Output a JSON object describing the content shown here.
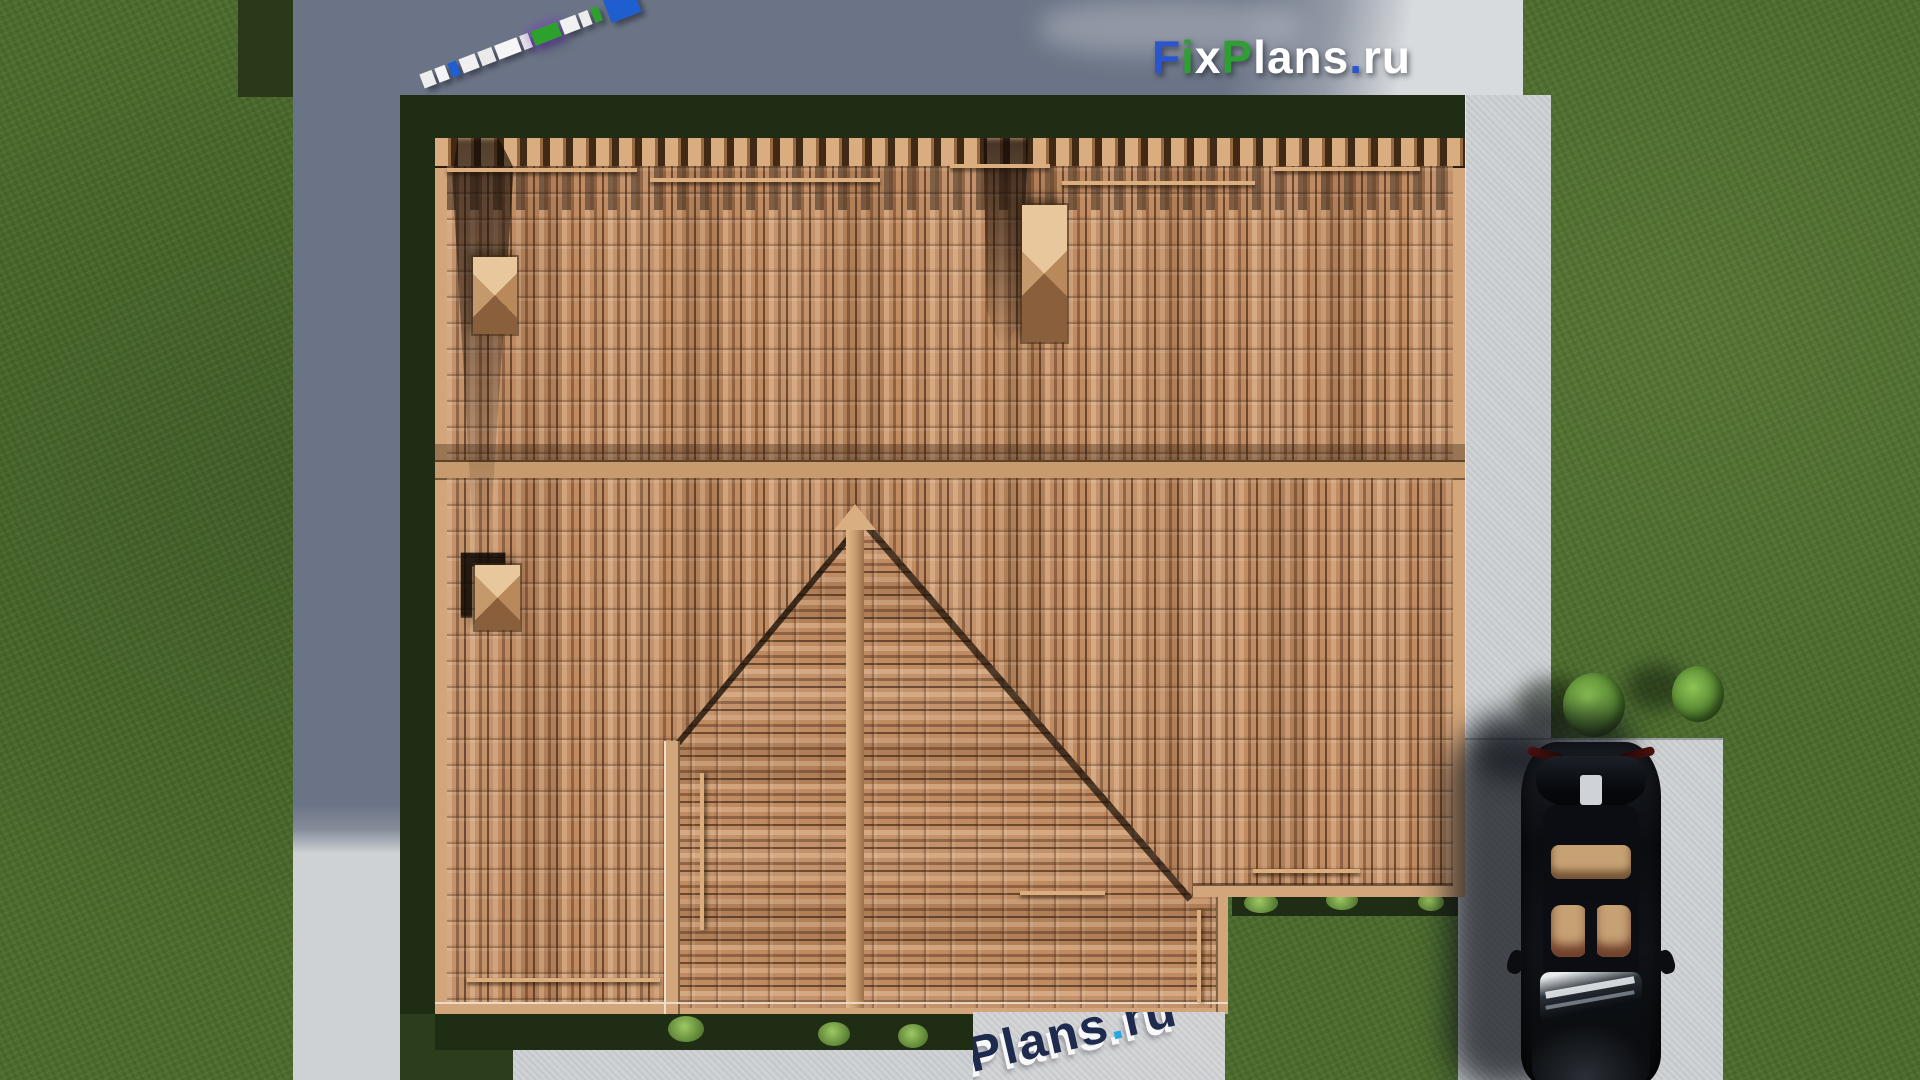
{
  "page": {
    "title": "FixPlans.ru — aerial top view render of tiled hip roof house"
  },
  "logo": {
    "parts": [
      {
        "text": "F",
        "style": "color:#2a55cd"
      },
      {
        "text": "i",
        "style": "color:#2f9e33"
      },
      {
        "text": "x",
        "style": "color:#ffffff"
      },
      {
        "text": "P",
        "style": "color:#2f9e33"
      },
      {
        "text": "lans",
        "style": "color:#ffffff"
      },
      {
        "text": ".",
        "style": "color:#2a55cd"
      },
      {
        "text": "ru",
        "style": "color:#ffffff"
      }
    ]
  },
  "watermark": {
    "parts": [
      {
        "text": "Plans",
        "style": "color:#1e2b4e"
      },
      {
        "text": ".",
        "style": "color:#27a8e0"
      },
      {
        "text": "ru",
        "style": "color:#1e2b4e"
      }
    ]
  },
  "ruler": {
    "segments": [
      {
        "color": "#ededed",
        "w": 13
      },
      {
        "color": "#f4f4f4",
        "w": 11
      },
      {
        "color": "#1f5ecf",
        "w": 9
      },
      {
        "color": "#f0f0f0",
        "w": 17
      },
      {
        "color": "#eaeaea",
        "w": 15
      },
      {
        "color": "#f6f6f6",
        "w": 24
      },
      {
        "color": "#e8e8e8",
        "w": 9
      },
      {
        "color": "#2ea02e",
        "w": 28,
        "glow": true
      },
      {
        "color": "#f1f1f1",
        "w": 17
      },
      {
        "color": "#ececec",
        "w": 10
      },
      {
        "color": "#2ea02e",
        "w": 8
      }
    ],
    "end_block": {
      "color": "#1f5ecf",
      "w": 32,
      "h": 27
    }
  },
  "palette": {
    "grass": "#4c6b2e",
    "grass-dark": "#1f2d14",
    "concrete-light": "#ced2d5",
    "concrete-shadow": "#6b7486",
    "roof-tile": "#c08b61",
    "roof-trim": "#d2a57a",
    "car-body": "#0b0d11",
    "car-seat": "#c6a174",
    "logo-blue": "#2a55cd",
    "logo-green": "#2f9e33",
    "wm-navy": "#1e2b4e",
    "wm-cyan": "#27a8e0",
    "ruler-blue": "#1f5ecf",
    "ruler-green": "#2ea02e"
  }
}
